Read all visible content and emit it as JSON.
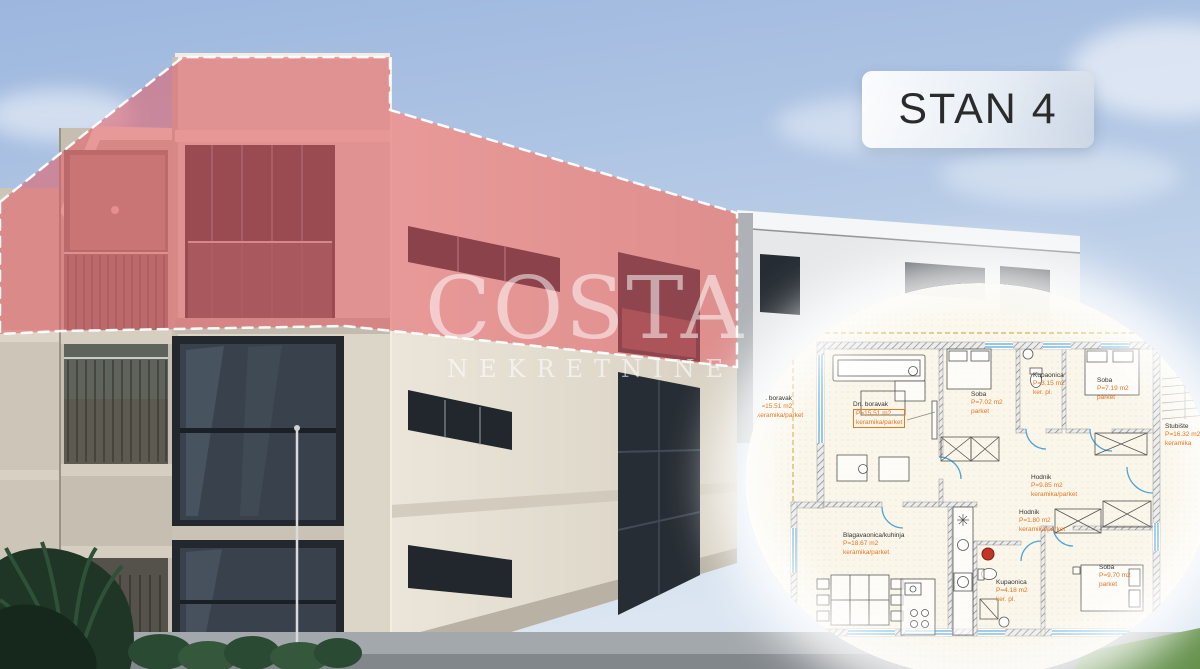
{
  "badge": {
    "label": "STAN 4"
  },
  "watermark": {
    "title": "COSTA",
    "subtitle": "NEKRETNINE"
  },
  "floor_plan": {
    "rooms": [
      {
        "name": "Dn. boravak",
        "area": "P=15.51 m2",
        "material": "keramika/parket"
      },
      {
        "name": "Dn. boravak",
        "area": "P=15.51 m2",
        "material": "keramika/parket"
      },
      {
        "name": "Soba",
        "area": "P=7.02 m2",
        "material": "parket"
      },
      {
        "name": "Kupaonica",
        "area": "P=3.15 m2",
        "material": "ker. pl."
      },
      {
        "name": "Soba",
        "area": "P=7.19 m2",
        "material": "parket"
      },
      {
        "name": "Stubište",
        "area": "P=16.32 m2",
        "material": "keramika"
      },
      {
        "name": "Hodnik",
        "area": "P=9.85 m2",
        "material": "keramika/parket"
      },
      {
        "name": "Hodnik",
        "area": "P=1.80 m2",
        "material": "keramika/parket"
      },
      {
        "name": "Blagavaonica/kuhinja",
        "area": "P=18.67 m2",
        "material": "keramika/parket"
      },
      {
        "name": "Kupaonica",
        "area": "P=4.18 m2",
        "material": "ker. pl."
      },
      {
        "name": "Soba",
        "area": "P=9.70 m2",
        "material": "parket"
      }
    ]
  },
  "colors": {
    "highlight_pink": "#e45a63",
    "outline_white": "#ffffff",
    "label_orange": "#e87722",
    "plan_blue": "#4fa3d8",
    "plan_gold": "#c8a22a",
    "badge_text": "#2b2b2b"
  }
}
